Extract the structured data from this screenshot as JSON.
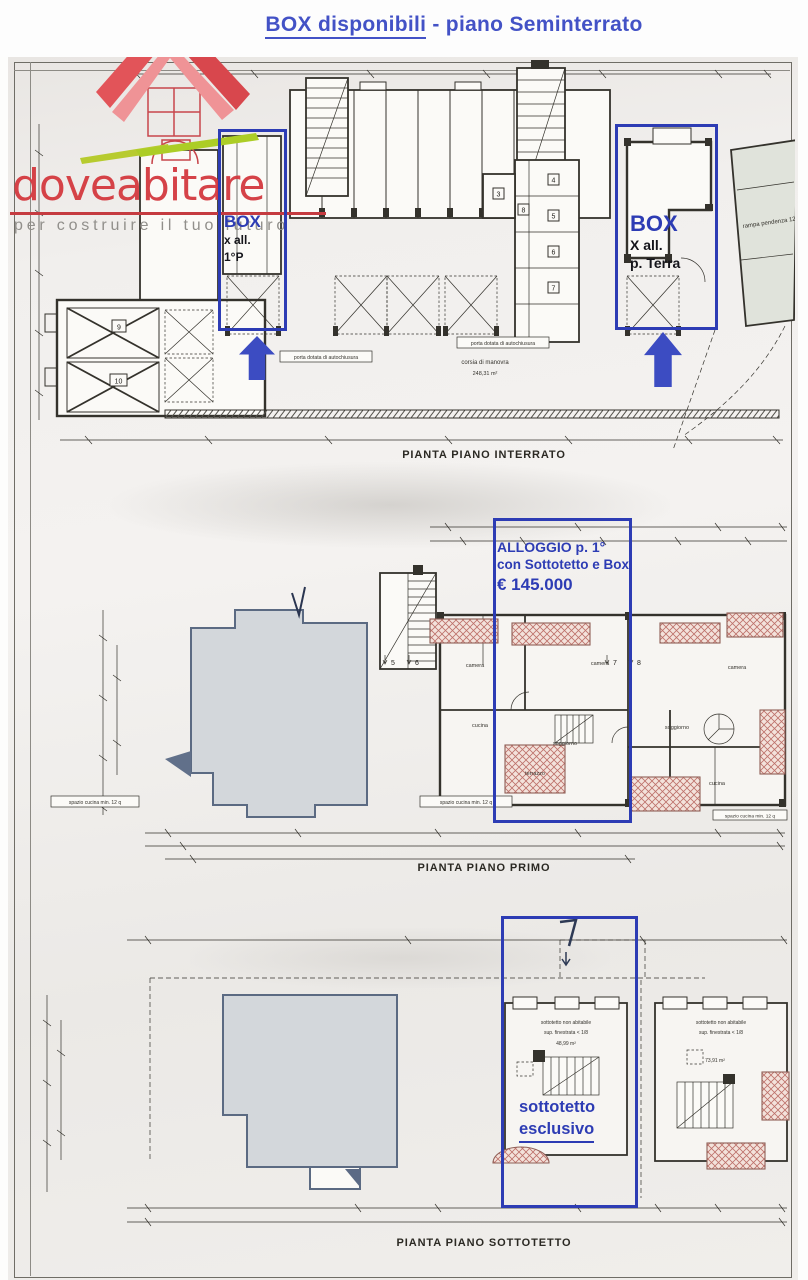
{
  "title": {
    "highlight": "BOX disponibili",
    "rest": " - piano Seminterrato"
  },
  "logo": {
    "name": "doveabitare",
    "tagline": "per costruire il tuo futuro"
  },
  "plans": [
    {
      "caption": "PIANTA PIANO INTERRATO"
    },
    {
      "caption": "PIANTA PIANO PRIMO"
    },
    {
      "caption": "PIANTA PIANO SOTTOTETTO"
    }
  ],
  "annotations": {
    "box_left": {
      "title": "BOX",
      "line1": "x all.",
      "line2": "1°P"
    },
    "box_right": {
      "title": "BOX",
      "line1": "X all.",
      "line2": "p. Terra"
    },
    "alloggio": {
      "line1": "ALLOGGIO p. 1°",
      "line2": "con Sottotetto e Box",
      "line3": "€ 145.000"
    },
    "sottotetto": {
      "line1": "sottotetto",
      "line2": "esclusivo"
    }
  },
  "plan1_labels": {
    "rampa": "rampa pendenza 12%",
    "porta": "porta dotata di autochiusura",
    "corsia": "corsia di manovra",
    "corsia_area": "248,31 m²",
    "room9": "9",
    "room10": "10",
    "cantina3": "3",
    "cantina4": "4",
    "cantina5": "5",
    "cantina6": "6",
    "cantina7": "7",
    "cantina8": "8"
  },
  "plan2_labels": {
    "camera": "camera",
    "cucina": "cucina",
    "soggiorno": "soggiorno",
    "terrazzo": "terrazzo",
    "kitchen_note": "spazio cucina min. 12 q",
    "unit5": "5",
    "unit6": "6",
    "unit7": "7",
    "unit8": "8"
  },
  "plan3_labels": {
    "non_abitabile": "sottotetto non abitabile",
    "finestrata": "sup. finestrata < 1/8",
    "area_left": "48,99 m²",
    "area_right": "73,91 m²"
  },
  "colors": {
    "annotation_blue": "#2d3cb4",
    "title_blue": "#4352c6",
    "arrow_blue": "#3c4cc2",
    "logo_red": "#d4393f",
    "tagline_gray": "#918f8b",
    "gray_fill": "#d3d7db"
  }
}
